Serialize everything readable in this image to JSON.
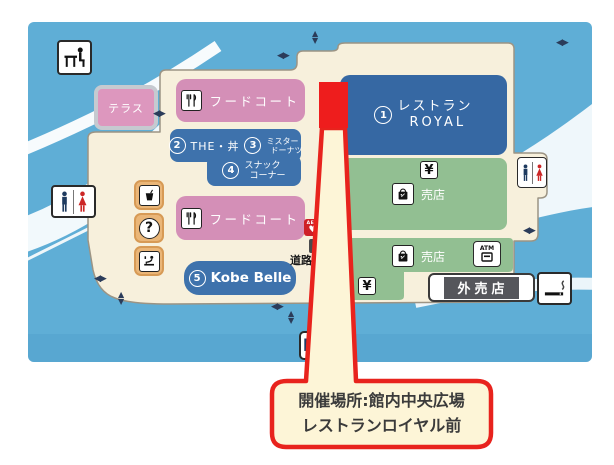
{
  "callout": {
    "line1": "開催場所:館内中央広場",
    "line2": "レストランロイヤル前",
    "border_color": "#e8231d",
    "bg_color": "#fdf5d7"
  },
  "map": {
    "colors": {
      "water_blue": "#5faed6",
      "building_cream": "#f7f0dc",
      "pink_block": "#d48fb7",
      "blue_block": "#3e72ac",
      "green_block": "#92bf92",
      "highlight_red": "#ee1d1d",
      "icon_tile_orange": "#eab678"
    },
    "blocks": {
      "terrace": {
        "label": "テラス"
      },
      "food_court_1": {
        "label": "フードコート"
      },
      "the_don": {
        "number": "2",
        "label": "THE・丼"
      },
      "mister_donut": {
        "number": "3",
        "label_line1": "ミスター",
        "label_line2": "ドーナツ"
      },
      "snack_corner": {
        "number": "4",
        "label_line1": "スナック",
        "label_line2": "コーナー"
      },
      "food_court_2": {
        "label": "フードコート"
      },
      "kobe_belle": {
        "number": "5",
        "label": "Kobe Belle"
      },
      "restaurant_royal": {
        "number": "1",
        "label_line1": "レストラン",
        "label_line2": "ROYAL"
      },
      "shop_upper": {
        "label": "売店"
      },
      "shop_lower": {
        "label": "売店"
      },
      "outside_shop": {
        "label": "外売店"
      },
      "road_info": {
        "label": "道路情報"
      }
    },
    "icon_labels": {
      "atm": "ATM",
      "aed": "AED",
      "parking": "P",
      "currency_exchange": "¥",
      "information": "?"
    },
    "arrows": {
      "left": "◀",
      "right": "▶",
      "up": "▲",
      "down": "▼"
    }
  }
}
